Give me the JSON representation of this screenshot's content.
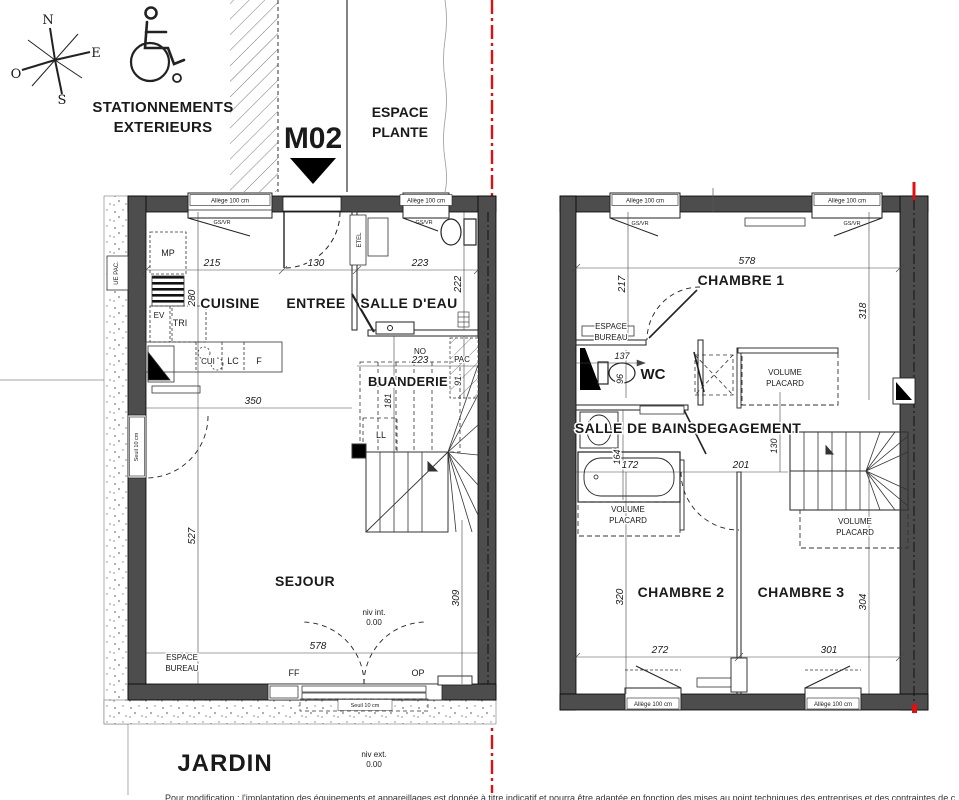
{
  "site": {
    "compass": {
      "n": "N",
      "e": "E",
      "s": "S",
      "o": "O"
    },
    "parking1": "STATIONNEMENTS",
    "parking2": "EXTERIEURS",
    "unit": "M02",
    "planted1": "ESPACE",
    "planted2": "PLANTE"
  },
  "common": {
    "allege": "Allège 100 cm",
    "gsvr": "GS/VR",
    "seuil": "Seuil 10 cm",
    "volume": "VOLUME",
    "placard": "PLACARD",
    "espace": "ESPACE",
    "bureau": "BUREAU",
    "zero": "0.00"
  },
  "gf": {
    "rooms": {
      "cuisine": "CUISINE",
      "entree": "ENTREE",
      "salle_deau": "SALLE D'EAU",
      "buanderie": "BUANDERIE",
      "sejour": "SEJOUR",
      "jardin": "JARDIN"
    },
    "labels": {
      "mp": "MP",
      "ev": "EV",
      "tri": "TRI",
      "cui": "CUI",
      "lc": "LC",
      "f": "F",
      "ll": "LL",
      "no": "NO",
      "pac": "PAC",
      "ue_pac": "UE PAC.",
      "etel": "ETEL",
      "ff": "FF",
      "op": "OP"
    },
    "levels": {
      "niv_int": "niv int.",
      "niv_ext": "niv ext."
    },
    "dims": {
      "d215": "215",
      "d130": "130",
      "d223a": "223",
      "d280": "280",
      "d222": "222",
      "d223b": "223",
      "d91": "91",
      "d181": "181",
      "d350": "350",
      "d527": "527",
      "d578": "578",
      "d309": "309"
    }
  },
  "ff": {
    "rooms": {
      "chambre1": "CHAMBRE 1",
      "wc": "WC",
      "salle_de_bains": "SALLE DE BAINS",
      "degagement": "DEGAGEMENT",
      "chambre2": "CHAMBRE 2",
      "chambre3": "CHAMBRE 3"
    },
    "dims": {
      "d578": "578",
      "d217": "217",
      "d318": "318",
      "d137": "137",
      "d96": "96",
      "d164": "164",
      "d172": "172",
      "d201": "201",
      "d130": "130",
      "d320": "320",
      "d304": "304",
      "d272": "272",
      "d301": "301"
    }
  },
  "footer": {
    "note": "Pour modification : l'implantation des équipements et appareillages est donnée à titre indicatif et pourra être adaptée en fonction des mises au point techniques des entreprises et des contraintes de chantier."
  }
}
